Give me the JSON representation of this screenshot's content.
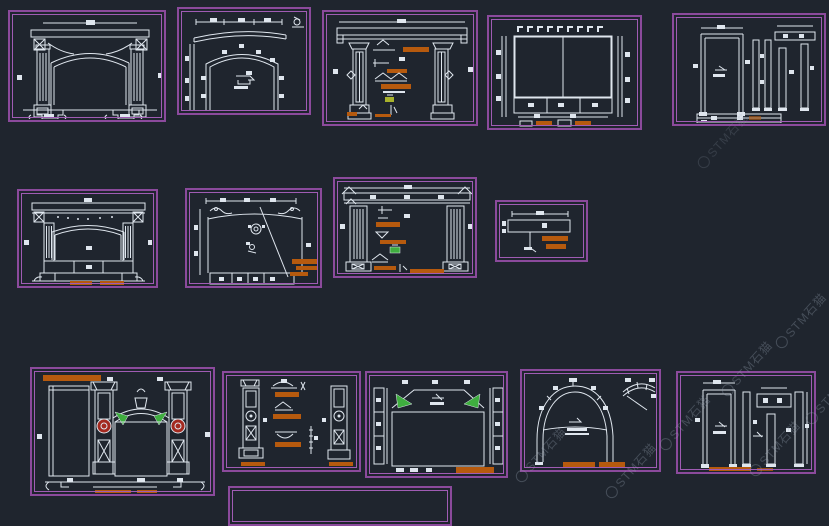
{
  "canvas": {
    "background": "#1f252e"
  },
  "palette": {
    "panel_border": "#8b4a9c",
    "panel_border_inner": "#a05cb4",
    "drawing_line": "#dfe6ee",
    "annotation_highlight": "#b65a0e",
    "accent_green": "#3fae3f",
    "accent_red": "#a3291f"
  },
  "watermark": {
    "text": "STM石猫"
  },
  "panels": [
    {
      "id": "fireplace-elevation-a"
    },
    {
      "id": "arch-dimension-detail-a"
    },
    {
      "id": "frame-annotated-details-a"
    },
    {
      "id": "speckled-wall-panel"
    },
    {
      "id": "door-frame-profiles-a"
    },
    {
      "id": "fireplace-elevation-b"
    },
    {
      "id": "arch-dimension-detail-b"
    },
    {
      "id": "frame-annotated-details-b"
    },
    {
      "id": "beam-detail"
    },
    {
      "id": "ornate-gate-elevation"
    },
    {
      "id": "column-details"
    },
    {
      "id": "lattice-panel"
    },
    {
      "id": "arch-detail"
    },
    {
      "id": "door-frame-profiles-b"
    },
    {
      "id": "partial-drawing-frame"
    }
  ]
}
